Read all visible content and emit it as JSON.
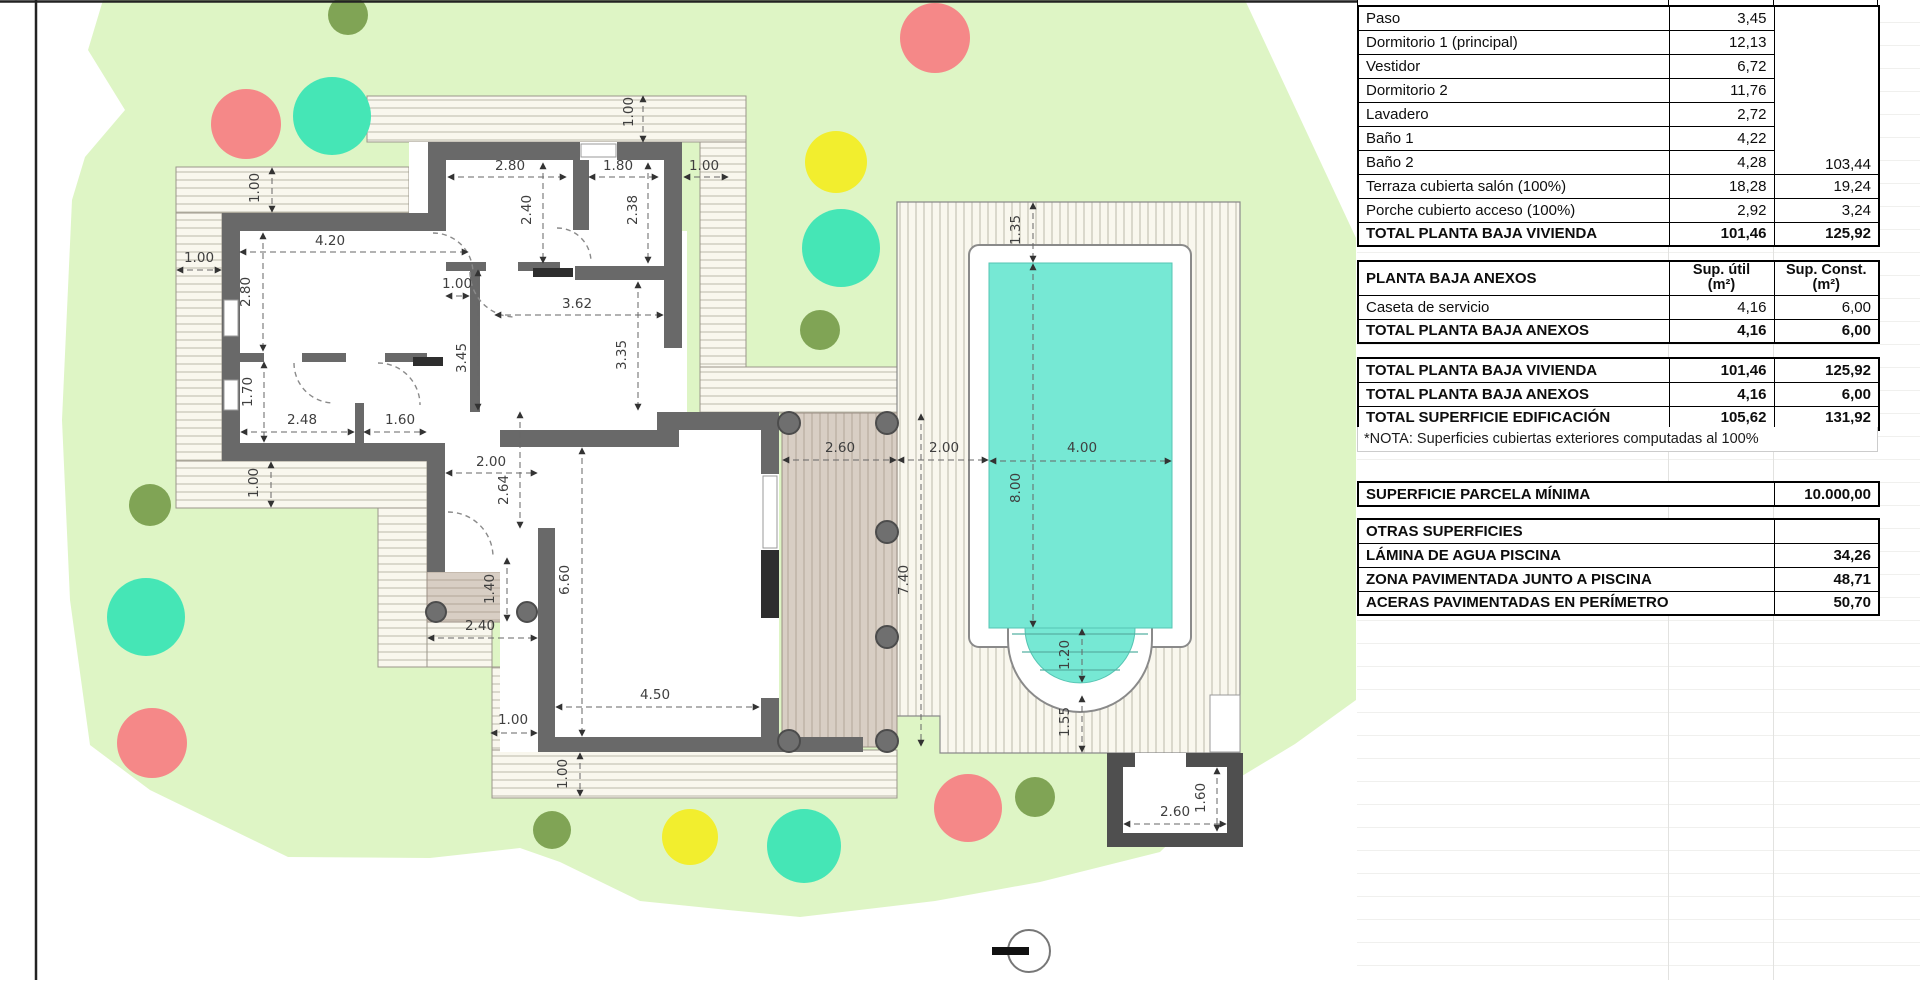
{
  "panel": {
    "x": 1357,
    "width": 521,
    "col_widths": [
      311,
      105,
      105
    ],
    "anexos_header": {
      "label": "PLANTA BAJA ANEXOS",
      "col1": "Sup. útil\n(m²)",
      "col2": "Sup. Const.\n(m²)"
    },
    "vivienda": {
      "rows": [
        {
          "label": "Paso",
          "su": "3,45"
        },
        {
          "label": "Dormitorio 1 (principal)",
          "su": "12,13"
        },
        {
          "label": "Vestidor",
          "su": "6,72"
        },
        {
          "label": "Dormitorio 2",
          "su": "11,76"
        },
        {
          "label": "Lavadero",
          "su": "2,72"
        },
        {
          "label": "Baño 1",
          "su": "4,22"
        },
        {
          "label": "Baño 2",
          "su": "4,28"
        }
      ],
      "merged_const": "103,44",
      "extra_rows": [
        {
          "label": "Terraza cubierta salón (100%)",
          "su": "18,28",
          "sc": "19,24"
        },
        {
          "label": "Porche cubierto acceso (100%)",
          "su": "2,92",
          "sc": "3,24"
        }
      ],
      "total": {
        "label": "TOTAL PLANTA BAJA VIVIENDA",
        "su": "101,46",
        "sc": "125,92"
      }
    },
    "anexos": {
      "rows": [
        {
          "label": "Caseta de servicio",
          "su": "4,16",
          "sc": "6,00"
        }
      ],
      "total": {
        "label": "TOTAL PLANTA BAJA ANEXOS",
        "su": "4,16",
        "sc": "6,00"
      }
    },
    "resumen": {
      "rows": [
        {
          "label": "TOTAL PLANTA BAJA VIVIENDA",
          "su": "101,46",
          "sc": "125,92"
        },
        {
          "label": "TOTAL PLANTA BAJA ANEXOS",
          "su": "4,16",
          "sc": "6,00"
        }
      ],
      "total": {
        "label": "TOTAL SUPERFICIE EDIFICACIÓN",
        "su": "105,62",
        "sc": "131,92"
      },
      "nota": "*NOTA: Superficies cubiertas exteriores computadas al 100%"
    },
    "parcela": {
      "label": "SUPERFICIE PARCELA MÍNIMA",
      "value": "10.000,00"
    },
    "otras": {
      "header": "OTRAS SUPERFICIES",
      "rows": [
        {
          "label": "LÁMINA DE AGUA PISCINA",
          "value": "34,26"
        },
        {
          "label": "ZONA PAVIMENTADA JUNTO A PISCINA",
          "value": "48,71"
        },
        {
          "label": "ACERAS PAVIMENTADAS EN PERÍMETRO",
          "value": "50,70"
        }
      ]
    }
  },
  "site_plan": {
    "colors": {
      "parcel": "#def5c5",
      "wall": "#696969",
      "wall_dark": "#4f4f4f",
      "deck_bg": "#f9f7ee",
      "deck_line": "#bcb8aa",
      "tan_bg": "#d8cec4",
      "tan_line": "#b2a598",
      "pool_water": "#76e8d4",
      "tree_red": "#f58888",
      "tree_teal": "#45e6b6",
      "tree_yellow": "#f2ee2e",
      "tree_olive": "#80a455"
    },
    "trees": [
      {
        "x": 348,
        "y": 15,
        "r": 20,
        "c": "tree_olive"
      },
      {
        "x": 246,
        "y": 124,
        "r": 35,
        "c": "tree_red"
      },
      {
        "x": 332,
        "y": 116,
        "r": 39,
        "c": "tree_teal"
      },
      {
        "x": 935,
        "y": 38,
        "r": 35,
        "c": "tree_red"
      },
      {
        "x": 836,
        "y": 162,
        "r": 31,
        "c": "tree_yellow"
      },
      {
        "x": 841,
        "y": 248,
        "r": 39,
        "c": "tree_teal"
      },
      {
        "x": 820,
        "y": 330,
        "r": 20,
        "c": "tree_olive"
      },
      {
        "x": 150,
        "y": 505,
        "r": 21,
        "c": "tree_olive"
      },
      {
        "x": 146,
        "y": 617,
        "r": 39,
        "c": "tree_teal"
      },
      {
        "x": 152,
        "y": 743,
        "r": 35,
        "c": "tree_red"
      },
      {
        "x": 552,
        "y": 830,
        "r": 19,
        "c": "tree_olive"
      },
      {
        "x": 690,
        "y": 837,
        "r": 28,
        "c": "tree_yellow"
      },
      {
        "x": 804,
        "y": 846,
        "r": 37,
        "c": "tree_teal"
      },
      {
        "x": 968,
        "y": 808,
        "r": 34,
        "c": "tree_red"
      },
      {
        "x": 1035,
        "y": 797,
        "r": 20,
        "c": "tree_olive"
      }
    ],
    "dimensions": [
      {
        "t": "2.80",
        "lx": 510,
        "ly": 170,
        "rot": 0,
        "x1": 448,
        "y1": 177,
        "x2": 566,
        "y2": 177
      },
      {
        "t": "1.80",
        "lx": 618,
        "ly": 170,
        "rot": 0,
        "x1": 589,
        "y1": 177,
        "x2": 658,
        "y2": 177
      },
      {
        "t": "1.00",
        "lx": 704,
        "ly": 170,
        "rot": 0,
        "x1": 684,
        "y1": 177,
        "x2": 728,
        "y2": 177
      },
      {
        "t": "1.00",
        "lx": 633,
        "ly": 112,
        "rot": 1,
        "x1": 643,
        "y1": 96,
        "x2": 643,
        "y2": 142
      },
      {
        "t": "2.40",
        "lx": 531,
        "ly": 210,
        "rot": 1,
        "x1": 543,
        "y1": 163,
        "x2": 543,
        "y2": 263
      },
      {
        "t": "2.38",
        "lx": 637,
        "ly": 210,
        "rot": 1,
        "x1": 648,
        "y1": 163,
        "x2": 648,
        "y2": 263
      },
      {
        "t": "4.20",
        "lx": 330,
        "ly": 245,
        "rot": 0,
        "x1": 240,
        "y1": 252,
        "x2": 468,
        "y2": 252
      },
      {
        "t": "2.80",
        "lx": 250,
        "ly": 292,
        "rot": 1,
        "x1": 263,
        "y1": 233,
        "x2": 263,
        "y2": 351
      },
      {
        "t": "1.00",
        "lx": 199,
        "ly": 262,
        "rot": 0,
        "x1": 177,
        "y1": 270,
        "x2": 221,
        "y2": 270
      },
      {
        "t": "1.00",
        "lx": 259,
        "ly": 188,
        "rot": 1,
        "x1": 272,
        "y1": 168,
        "x2": 272,
        "y2": 212
      },
      {
        "t": "1.70",
        "lx": 252,
        "ly": 392,
        "rot": 1,
        "x1": 264,
        "y1": 362,
        "x2": 264,
        "y2": 442
      },
      {
        "t": "2.48",
        "lx": 302,
        "ly": 424,
        "rot": 0,
        "x1": 241,
        "y1": 432,
        "x2": 354,
        "y2": 432
      },
      {
        "t": "1.60",
        "lx": 400,
        "ly": 424,
        "rot": 0,
        "x1": 364,
        "y1": 432,
        "x2": 426,
        "y2": 432
      },
      {
        "t": "3.45",
        "lx": 466,
        "ly": 358,
        "rot": 1,
        "x1": 478,
        "y1": 270,
        "x2": 478,
        "y2": 410
      },
      {
        "t": "1.00",
        "lx": 457,
        "ly": 288,
        "rot": 0,
        "x1": 446,
        "y1": 296,
        "x2": 469,
        "y2": 296
      },
      {
        "t": "3.62",
        "lx": 577,
        "ly": 308,
        "rot": 0,
        "x1": 495,
        "y1": 315,
        "x2": 663,
        "y2": 315
      },
      {
        "t": "3.35",
        "lx": 626,
        "ly": 355,
        "rot": 1,
        "x1": 638,
        "y1": 282,
        "x2": 638,
        "y2": 410
      },
      {
        "t": "2.00",
        "lx": 491,
        "ly": 466,
        "rot": 0,
        "x1": 446,
        "y1": 473,
        "x2": 537,
        "y2": 473
      },
      {
        "t": "2.64",
        "lx": 508,
        "ly": 490,
        "rot": 1,
        "x1": 520,
        "y1": 412,
        "x2": 520,
        "y2": 528
      },
      {
        "t": "1.00",
        "lx": 258,
        "ly": 483,
        "rot": 1,
        "x1": 271,
        "y1": 462,
        "x2": 271,
        "y2": 507
      },
      {
        "t": "1.40",
        "lx": 494,
        "ly": 589,
        "rot": 1,
        "x1": 507,
        "y1": 558,
        "x2": 507,
        "y2": 621
      },
      {
        "t": "2.40",
        "lx": 480,
        "ly": 630,
        "rot": 0,
        "x1": 428,
        "y1": 638,
        "x2": 537,
        "y2": 638
      },
      {
        "t": "6.60",
        "lx": 569,
        "ly": 580,
        "rot": 1,
        "x1": 582,
        "y1": 448,
        "x2": 582,
        "y2": 736
      },
      {
        "t": "4.50",
        "lx": 655,
        "ly": 699,
        "rot": 0,
        "x1": 556,
        "y1": 707,
        "x2": 759,
        "y2": 707
      },
      {
        "t": "1.00",
        "lx": 513,
        "ly": 724,
        "rot": 0,
        "x1": 491,
        "y1": 733,
        "x2": 537,
        "y2": 733
      },
      {
        "t": "1.00",
        "lx": 567,
        "ly": 774,
        "rot": 1,
        "x1": 580,
        "y1": 753,
        "x2": 580,
        "y2": 796
      },
      {
        "t": "2.60",
        "lx": 840,
        "ly": 452,
        "rot": 0,
        "x1": 783,
        "y1": 460,
        "x2": 896,
        "y2": 460
      },
      {
        "t": "2.00",
        "lx": 944,
        "ly": 452,
        "rot": 0,
        "x1": 898,
        "y1": 460,
        "x2": 988,
        "y2": 460
      },
      {
        "t": "7.40",
        "lx": 908,
        "ly": 580,
        "rot": 1,
        "x1": 921,
        "y1": 414,
        "x2": 921,
        "y2": 746
      },
      {
        "t": "1.35",
        "lx": 1020,
        "ly": 230,
        "rot": 1,
        "x1": 1033,
        "y1": 203,
        "x2": 1033,
        "y2": 262
      },
      {
        "t": "8.00",
        "lx": 1020,
        "ly": 488,
        "rot": 1,
        "x1": 1033,
        "y1": 264,
        "x2": 1033,
        "y2": 627
      },
      {
        "t": "4.00",
        "lx": 1082,
        "ly": 452,
        "rot": 0,
        "x1": 990,
        "y1": 461,
        "x2": 1171,
        "y2": 461
      },
      {
        "t": "1.20",
        "lx": 1069,
        "ly": 655,
        "rot": 1,
        "x1": 1082,
        "y1": 629,
        "x2": 1082,
        "y2": 682
      },
      {
        "t": "1.55",
        "lx": 1069,
        "ly": 722,
        "rot": 1,
        "x1": 1082,
        "y1": 696,
        "x2": 1082,
        "y2": 752
      },
      {
        "t": "2.60",
        "lx": 1175,
        "ly": 816,
        "rot": 0,
        "x1": 1124,
        "y1": 824,
        "x2": 1226,
        "y2": 824
      },
      {
        "t": "1.60",
        "lx": 1205,
        "ly": 798,
        "rot": 1,
        "x1": 1217,
        "y1": 768,
        "x2": 1217,
        "y2": 831
      }
    ]
  }
}
